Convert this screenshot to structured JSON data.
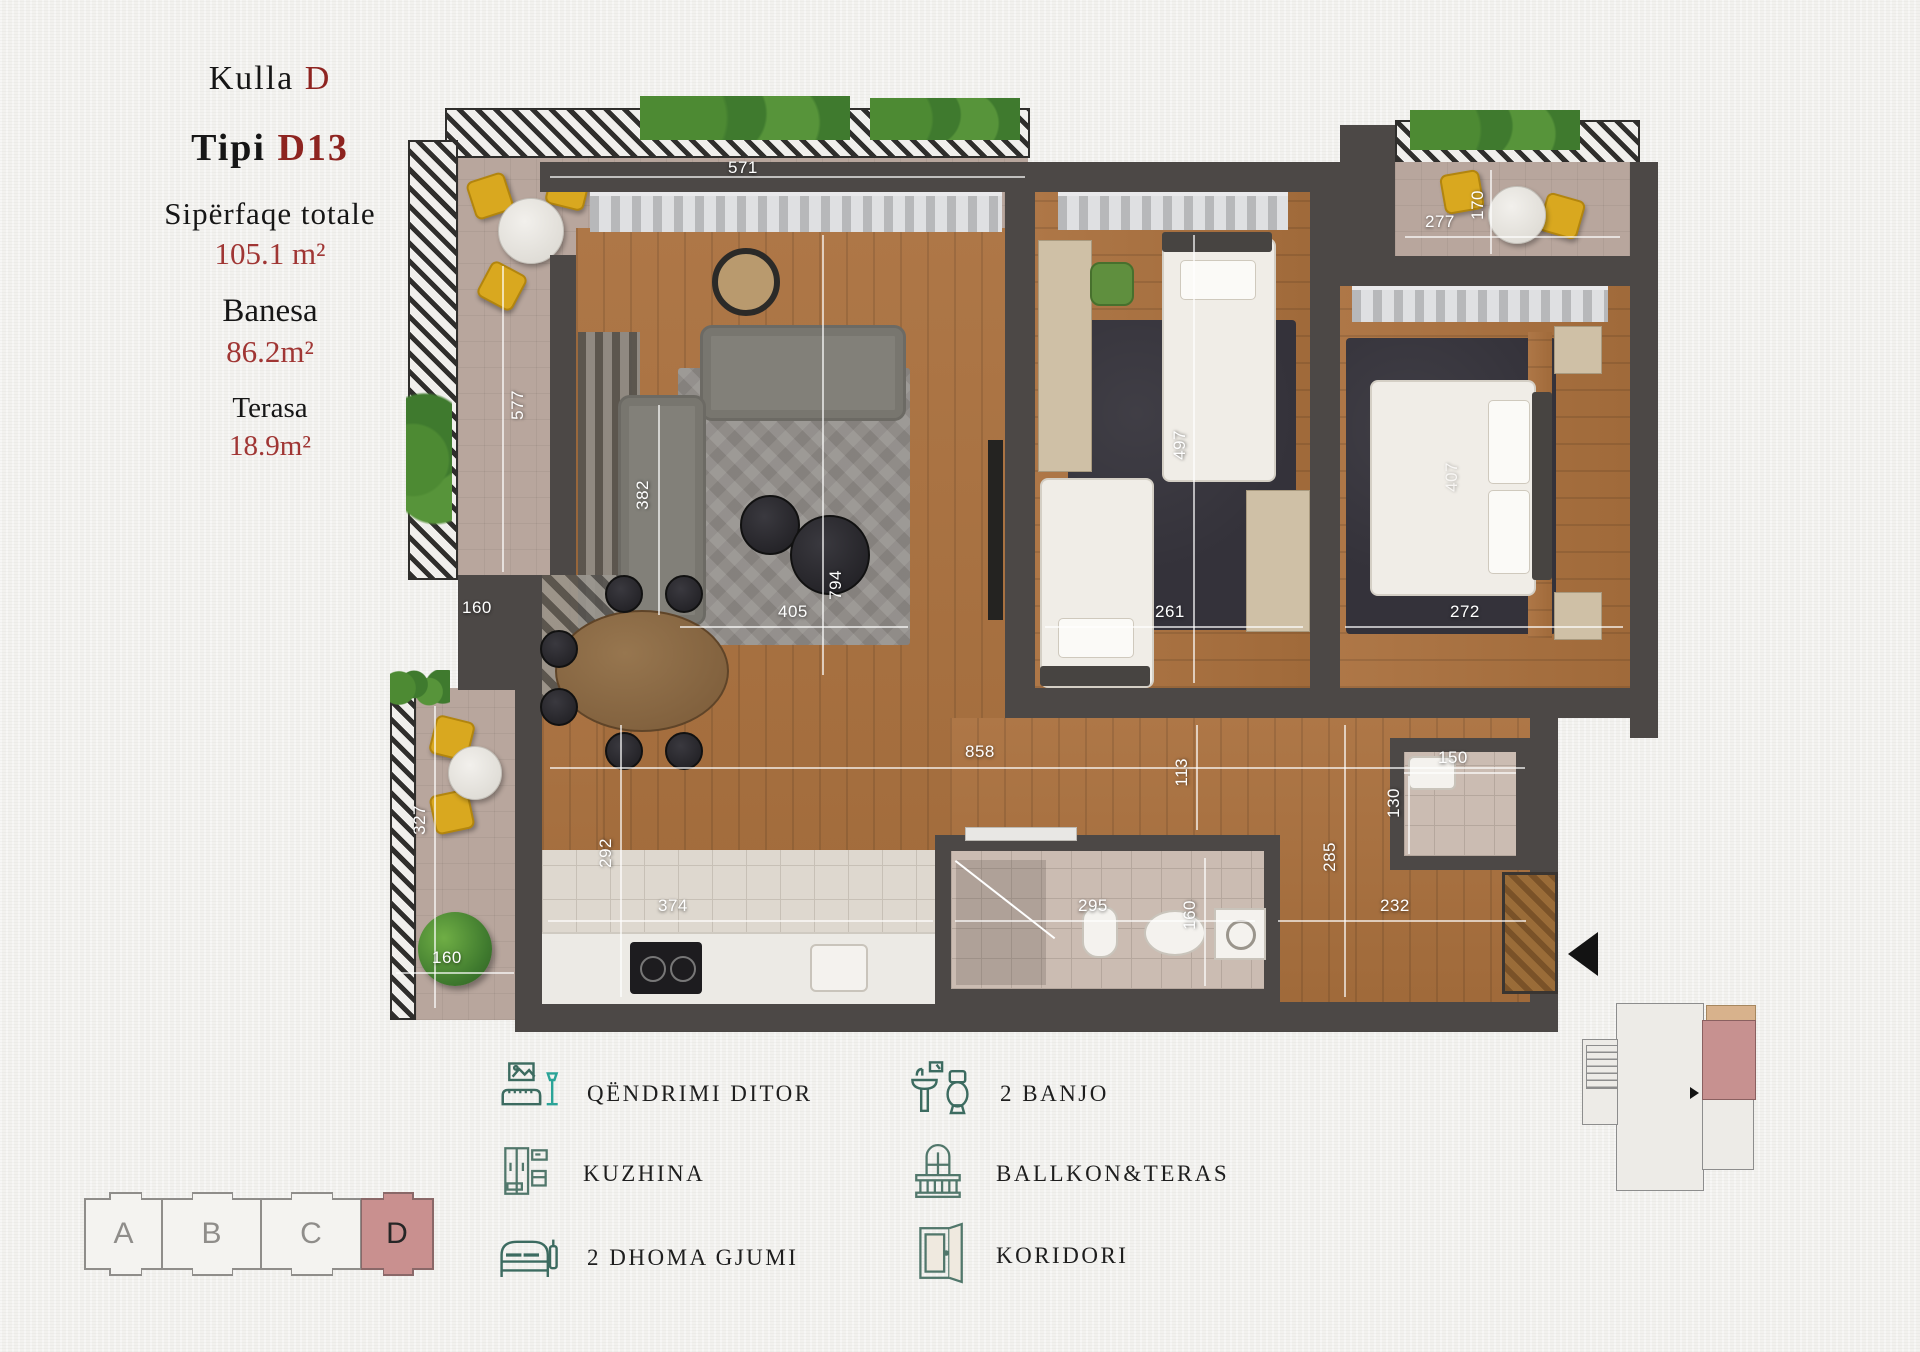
{
  "title_panel": {
    "kulla_label": "Kulla",
    "kulla_value": "D",
    "tipi_label": "Tipi",
    "tipi_value": "D13",
    "total_label": "Sipërfaqe totale",
    "total_value": "105.1 m²",
    "banesa_label": "Banesa",
    "banesa_value": "86.2m²",
    "terasa_label": "Terasa",
    "terasa_value": "18.9m²"
  },
  "plan": {
    "dims": [
      {
        "v": "571",
        "o": "h"
      },
      {
        "v": "277",
        "o": "h"
      },
      {
        "v": "170",
        "o": "v"
      },
      {
        "v": "577",
        "o": "v"
      },
      {
        "v": "382",
        "o": "v"
      },
      {
        "v": "160",
        "o": "h"
      },
      {
        "v": "405",
        "o": "h"
      },
      {
        "v": "794",
        "o": "v"
      },
      {
        "v": "261",
        "o": "h"
      },
      {
        "v": "497",
        "o": "v"
      },
      {
        "v": "272",
        "o": "h"
      },
      {
        "v": "407",
        "o": "v"
      },
      {
        "v": "858",
        "o": "h"
      },
      {
        "v": "113",
        "o": "v"
      },
      {
        "v": "150",
        "o": "h"
      },
      {
        "v": "130",
        "o": "v"
      },
      {
        "v": "295",
        "o": "h"
      },
      {
        "v": "160",
        "o": "v"
      },
      {
        "v": "292",
        "o": "v"
      },
      {
        "v": "374",
        "o": "h"
      },
      {
        "v": "160",
        "o": "h"
      },
      {
        "v": "327",
        "o": "v"
      },
      {
        "v": "285",
        "o": "v"
      },
      {
        "v": "232",
        "o": "h"
      }
    ]
  },
  "legend": {
    "items": [
      {
        "icon": "living-room-icon",
        "label": "QËNDRIMI DITOR"
      },
      {
        "icon": "kitchen-icon",
        "label": "KUZHINA"
      },
      {
        "icon": "bedroom-icon",
        "label": "2 DHOMA GJUMI"
      },
      {
        "icon": "bathroom-icon",
        "label": "2 BANJO"
      },
      {
        "icon": "balcony-icon",
        "label": "BALLKON&TERAS"
      },
      {
        "icon": "corridor-icon",
        "label": "KORIDORI"
      }
    ]
  },
  "building_strip": {
    "sections": [
      {
        "label": "A",
        "highlighted": false
      },
      {
        "label": "B",
        "highlighted": false
      },
      {
        "label": "C",
        "highlighted": false
      },
      {
        "label": "D",
        "highlighted": true
      }
    ]
  },
  "colors": {
    "accent_red": "#8e2420",
    "highlight_pink": "#c9908f",
    "keyplan_tan": "#d8b28c",
    "wall_dark": "#4c4846",
    "icon_green": "#3c6b60",
    "wood": "#a9713f",
    "yellow_chair": "#d9a81f"
  }
}
